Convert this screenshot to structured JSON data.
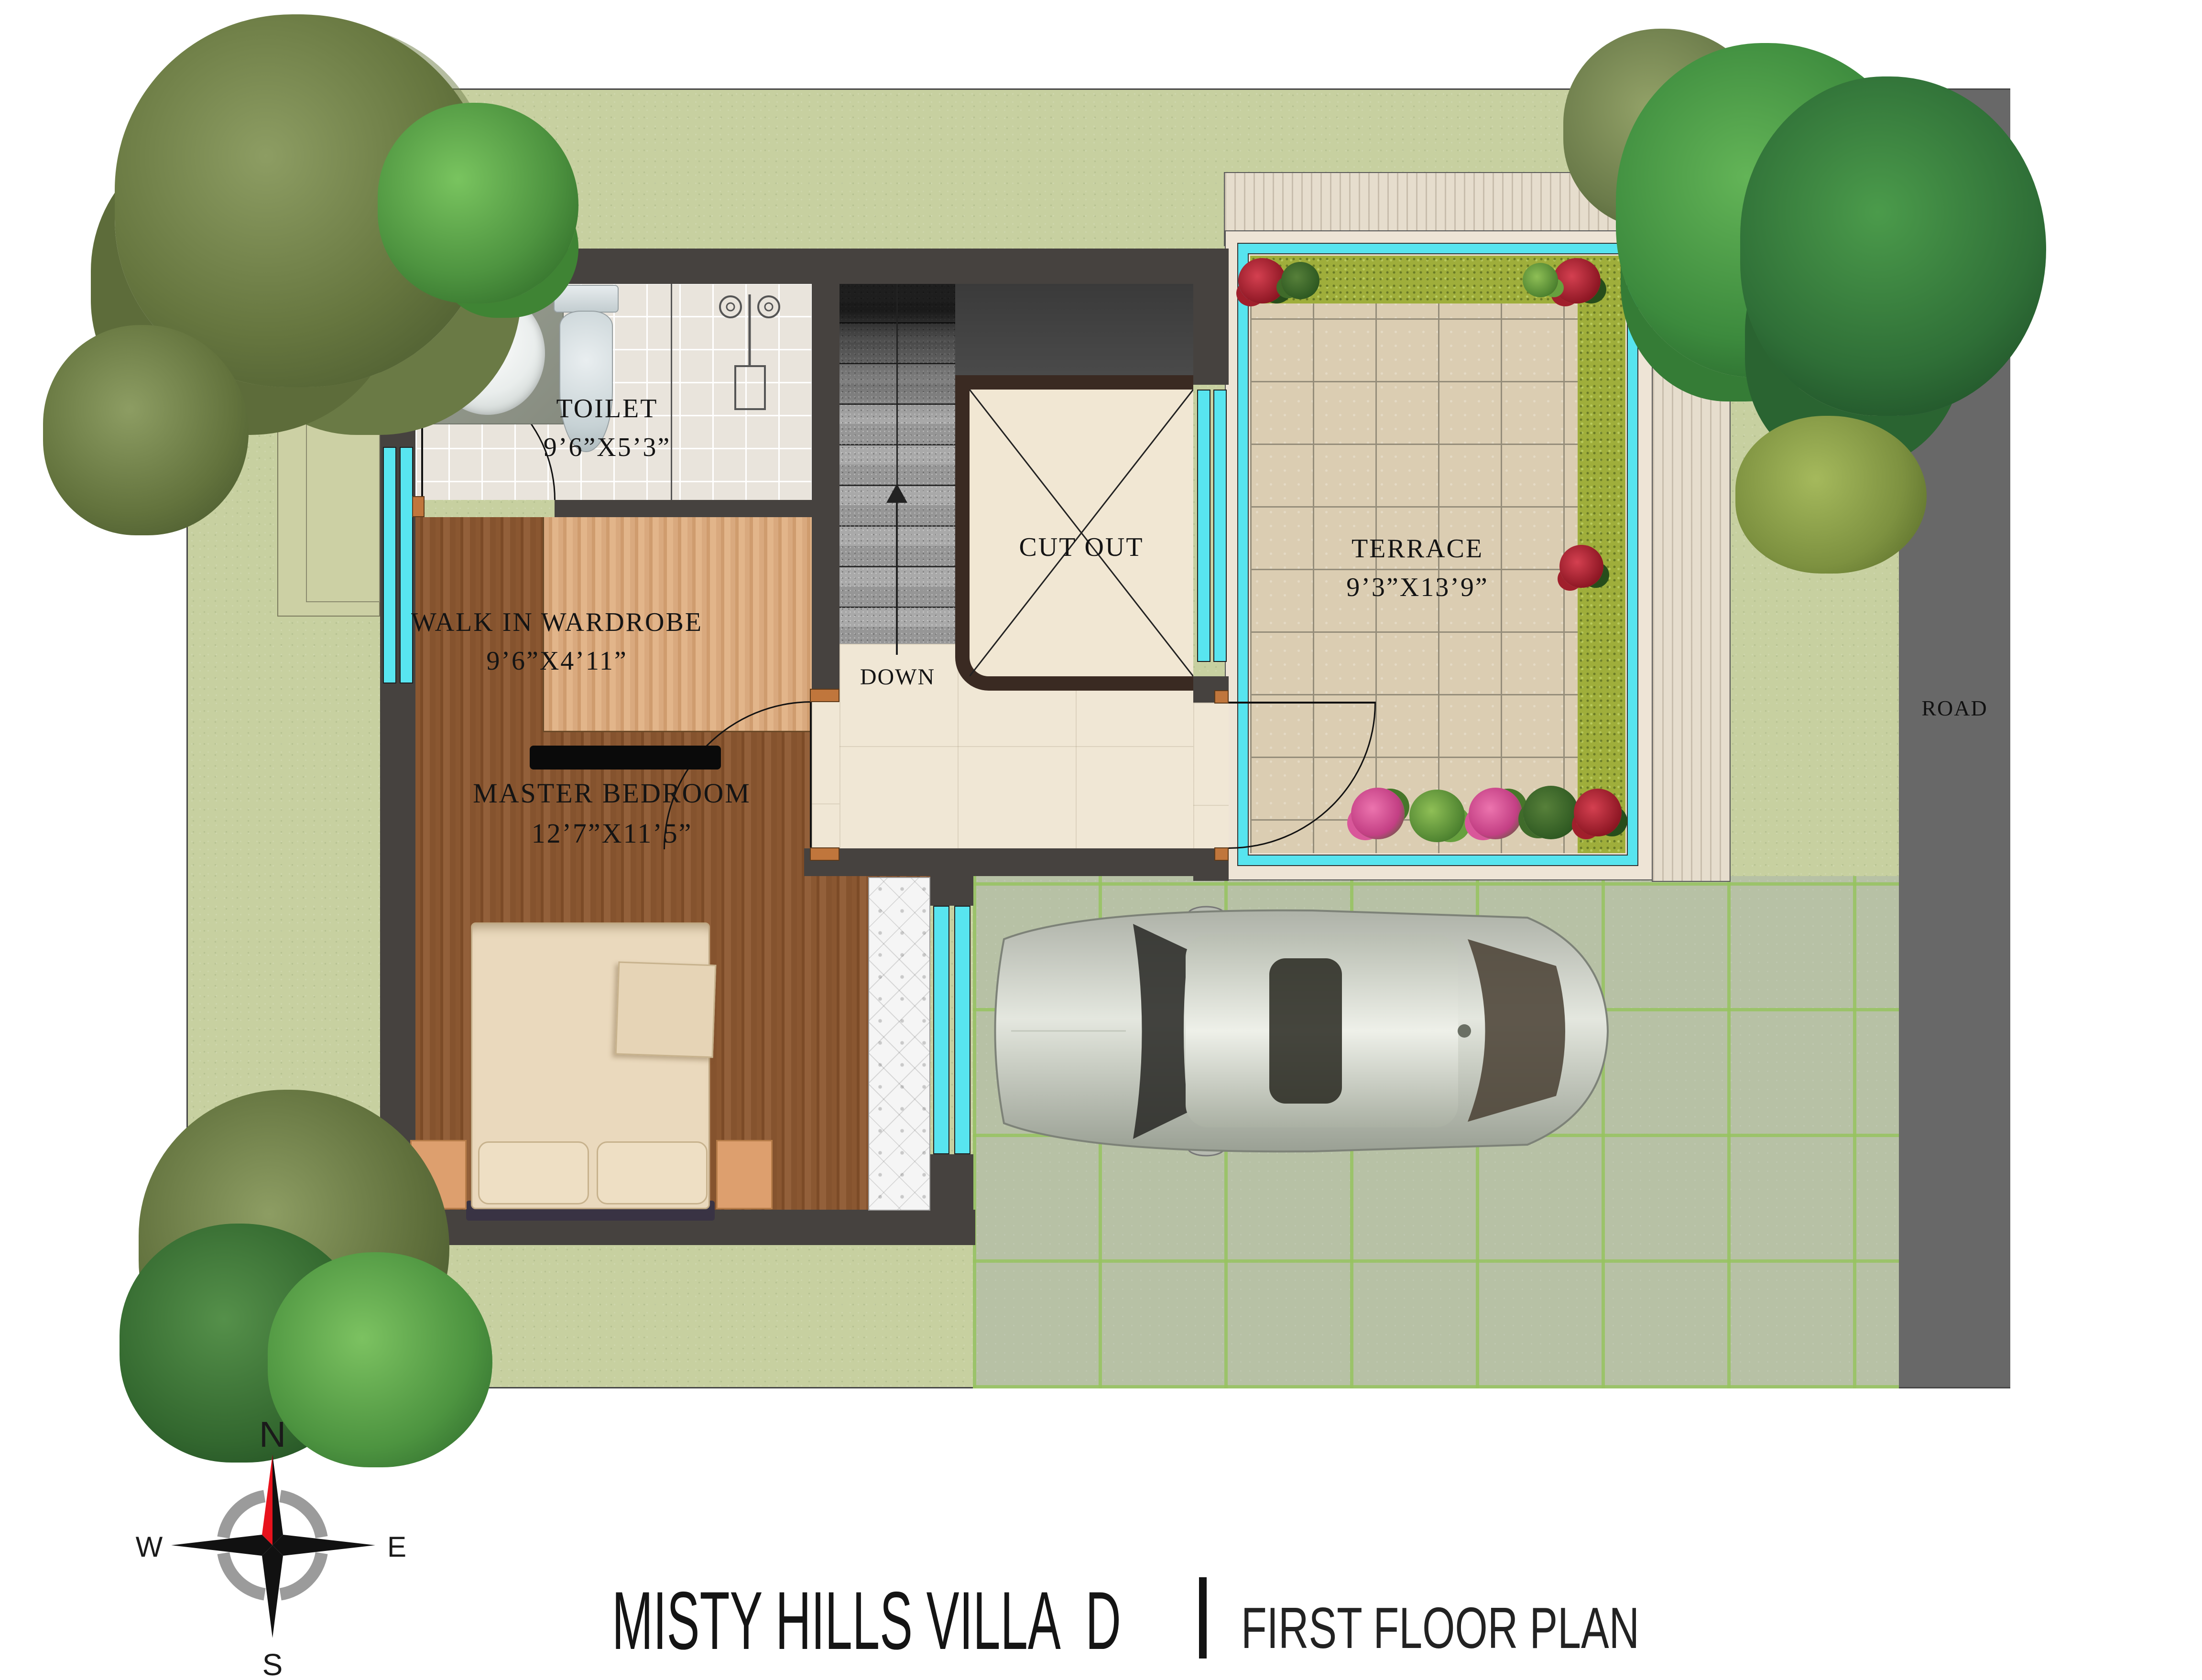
{
  "title": {
    "project": "MISTY HILLS VILLA  D",
    "separator": "|",
    "plan": "FIRST FLOOR PLAN"
  },
  "site": {
    "road_label": "ROAD"
  },
  "rooms": {
    "toilet": {
      "name": "TOILET",
      "dims": "9’6”X5’3”"
    },
    "wardrobe": {
      "name": "WALK IN WARDROBE",
      "dims": "9’6”X4’11”"
    },
    "master_bedroom": {
      "name": "MASTER BEDROOM",
      "dims": "12’7”X11’5”"
    },
    "cut_out": {
      "name": "CUT OUT"
    },
    "terrace": {
      "name": "TERRACE",
      "dims": "9’3”X13’9”"
    },
    "stairs": {
      "direction_label": "DOWN"
    }
  },
  "compass": {
    "north": "N",
    "south": "S",
    "east": "E",
    "west": "W"
  },
  "colors": {
    "wall": "#46423f",
    "window_glass": "#58e5f0",
    "lawn": "#c7d0a0",
    "road": "#686868",
    "driveway": "#b7c1a5",
    "deck": "#e6ddcd",
    "terrace_tile": "#dbcdb2",
    "hedge": "#9fae3b",
    "wood_dark": "#8a5731",
    "wood_light": "#d9a97e",
    "bathroom_tile": "#e9e4dc",
    "cutout_border": "#3a2a22",
    "bed": "#ead9bd",
    "sofa": "#f5f5f5",
    "nightstand": "#dd9f6e",
    "car": "#c9cdc4",
    "compass_north": "#e8121c"
  }
}
